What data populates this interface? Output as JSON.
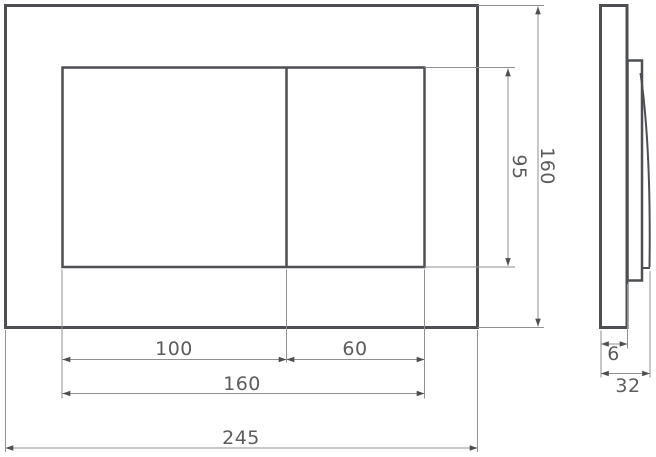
{
  "dimensions": {
    "front_view": {
      "left_button_width": "100",
      "right_button_width": "60",
      "button_area_width": "160",
      "plate_width": "245",
      "button_area_height": "95",
      "plate_height": "160"
    },
    "side_view": {
      "plate_thickness": "6",
      "overall_depth": "32"
    }
  },
  "colors": {
    "outline": "#4d4f52",
    "dimension_line": "#8e9092",
    "label_text": "#5a5c5e",
    "background": "#ffffff"
  }
}
